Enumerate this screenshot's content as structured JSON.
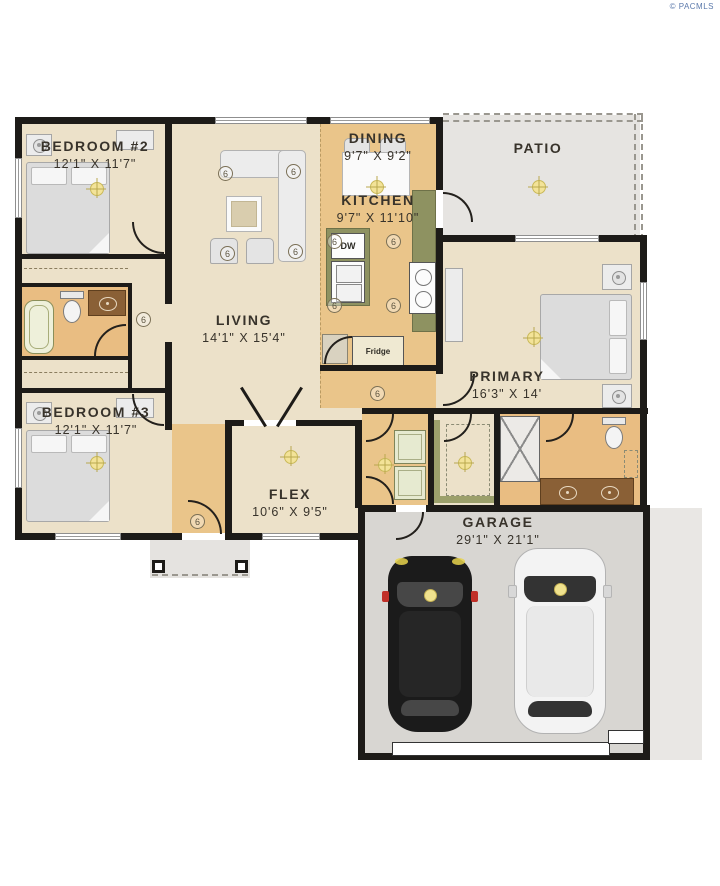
{
  "watermark": "© PACMLS",
  "rooms": {
    "bedroom2": {
      "name": "BEDROOM #2",
      "dims": "12'1\" X 11'7\""
    },
    "dining": {
      "name": "DINING",
      "dims": "9'7\" X 9'2\""
    },
    "kitchen": {
      "name": "KITCHEN",
      "dims": "9'7\" X 11'10\""
    },
    "patio": {
      "name": "PATIO"
    },
    "living": {
      "name": "LIVING",
      "dims": "14'1\" X 15'4\""
    },
    "primary": {
      "name": "PRIMARY",
      "dims": "16'3\" X 14'"
    },
    "bedroom3": {
      "name": "BEDROOM #3",
      "dims": "12'1\" X 11'7\""
    },
    "flex": {
      "name": "FLEX",
      "dims": "10'6\" X 9'5\""
    },
    "garage": {
      "name": "GARAGE",
      "dims": "29'1\" X 21'1\""
    }
  },
  "appliances": {
    "dishwasher": "DW",
    "fridge": "Fridge"
  },
  "markers": {
    "ceiling_height": "6"
  },
  "colors": {
    "wall": "#1d1b18",
    "floor_cream": "#ece1c9",
    "floor_wood": "#eac58a",
    "floor_bath": "#e9bd82",
    "patio_gray": "#e6e4e1",
    "garage_gray": "#d8d6d2",
    "counter_olive": "#8e9261",
    "vanity_brown": "#8a6036",
    "light_yellow": "#f3e398",
    "watermark_blue": "#5b79ab"
  }
}
